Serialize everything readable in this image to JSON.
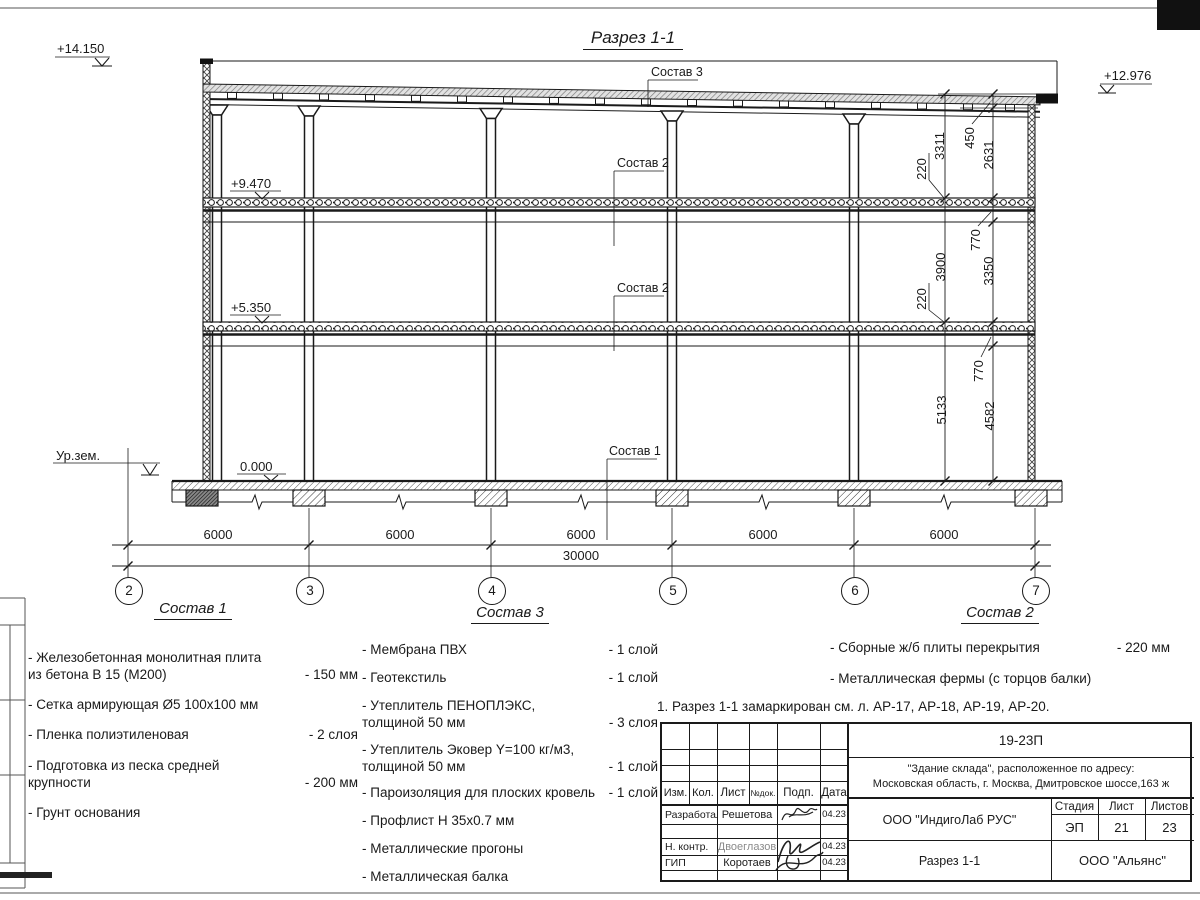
{
  "drawing": {
    "title": "Разрез 1-1",
    "elevations": {
      "roof_left": "+14.150",
      "roof_right": "+12.976",
      "slab_upper": "+9.470",
      "slab_lower": "+5.350",
      "floor": "0.000",
      "ground": "Ур.зем."
    },
    "callouts": {
      "roof": "Состав 3",
      "slab_upper": "Состав 2",
      "slab_lower": "Состав 2",
      "floor": "Состав 1"
    },
    "axes": [
      "2",
      "3",
      "4",
      "5",
      "6",
      "7"
    ],
    "dims": {
      "bottom_segments": [
        "6000",
        "6000",
        "6000",
        "6000",
        "6000"
      ],
      "bottom_total": "30000",
      "right_main": [
        "3311",
        "3900",
        "5133"
      ],
      "right_slab_thickness": [
        "220",
        "220"
      ],
      "right_detail": [
        "450",
        "2631",
        "770",
        "3350",
        "770",
        "4582"
      ]
    }
  },
  "legends": {
    "sostav1": {
      "title": "Состав 1",
      "items": [
        {
          "text": "- Железобетонная  монолитная плита\nиз бетона В 15 (М200)",
          "value": "- 150 мм"
        },
        {
          "text": "- Сетка армирующая Ø5 100x100 мм",
          "value": ""
        },
        {
          "text": "- Пленка полиэтиленовая",
          "value": "-  2 слоя"
        },
        {
          "text": "- Подготовка из песка средней\nкрупности",
          "value": "- 200 мм"
        },
        {
          "text": "- Грунт основания",
          "value": ""
        }
      ]
    },
    "sostav3": {
      "title": "Состав 3",
      "items": [
        {
          "text": "- Мембрана ПВХ",
          "value": "- 1 слой"
        },
        {
          "text": "- Геотекстиль",
          "value": "- 1 слой"
        },
        {
          "text": "- Утеплитель ПЕНОПЛЭКС,\nтолщиной 50 мм",
          "value": "- 3 слоя"
        },
        {
          "text": "- Утеплитель Эковер Y=100 кг/м3,\nтолщиной 50 мм",
          "value": "- 1 слой"
        },
        {
          "text": "- Пароизоляция для плоских кровель",
          "value": "- 1 слой"
        },
        {
          "text": "- Профлист Н 35x0.7 мм",
          "value": ""
        },
        {
          "text": "- Металлические прогоны",
          "value": ""
        },
        {
          "text": "- Металлическая балка",
          "value": ""
        }
      ]
    },
    "sostav2": {
      "title": "Состав 2",
      "items": [
        {
          "text": "- Сборные ж/б плиты перекрытия",
          "value": "- 220 мм"
        },
        {
          "text": "- Металлическая фермы (с торцов балки)",
          "value": ""
        }
      ]
    }
  },
  "note": "1. Разрез 1-1 замаркирован см. л. АР-17, АР-18, АР-19, АР-20.",
  "titleblock": {
    "doc_number": "19-23П",
    "project": "\"Здание склада\", расположенное по адресу:\nМосковская область, г. Москва, Дмитровское шоссе,163 ж",
    "columns": [
      "Изм.",
      "Кол.",
      "Лист",
      "№док.",
      "Подп.",
      "Дата"
    ],
    "rows": [
      {
        "role": "Разработал",
        "name": "Решетова",
        "date": "04.23"
      },
      {
        "role": "Н. контр.",
        "name": "Двоеглазов",
        "date": "04.23"
      },
      {
        "role": "ГИП",
        "name": "Коротаев",
        "date": "04.23"
      }
    ],
    "org": "ООО \"ИндигоЛаб РУС\"",
    "stage_label": "Стадия",
    "sheet_label": "Лист",
    "sheets_label": "Листов",
    "stage": "ЭП",
    "sheet": "21",
    "sheets": "23",
    "drawing_title": "Разрез 1-1",
    "org2": "ООО \"Альянс\""
  }
}
